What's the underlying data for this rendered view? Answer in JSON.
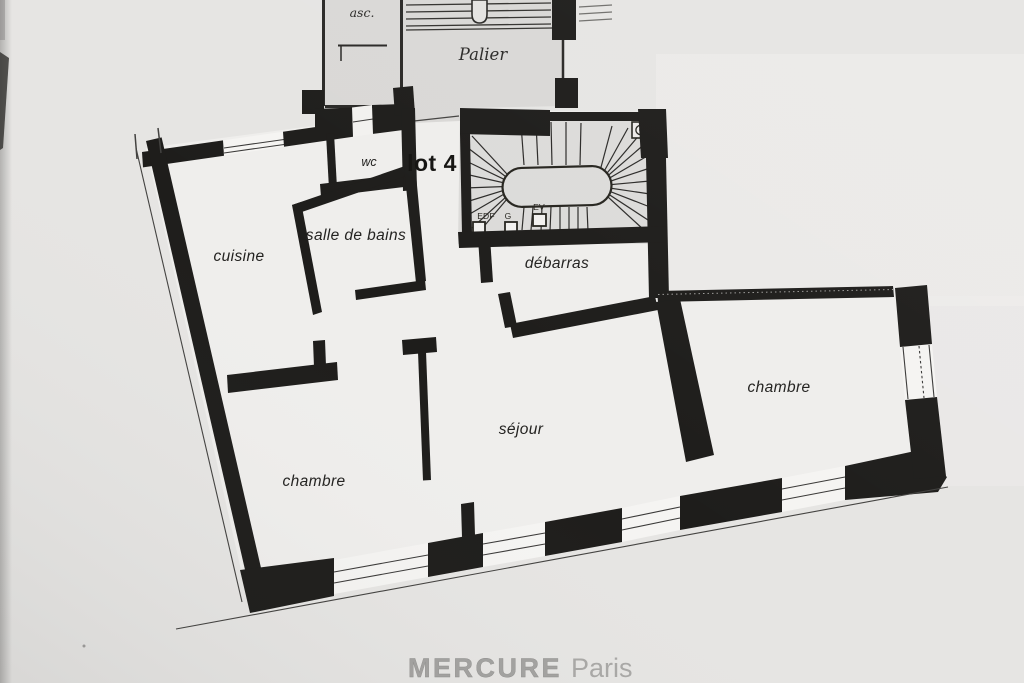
{
  "plan": {
    "unit_label": "lot 4",
    "common_areas": {
      "elevator": "asc.",
      "landing": "Palier"
    },
    "rooms": [
      {
        "id": "wc",
        "label": "wc"
      },
      {
        "id": "cuisine",
        "label": "cuisine"
      },
      {
        "id": "salle_de_bains",
        "label": "salle de bains"
      },
      {
        "id": "debarras",
        "label": "débarras"
      },
      {
        "id": "sejour",
        "label": "séjour"
      },
      {
        "id": "chambre_1",
        "label": "chambre"
      },
      {
        "id": "chambre_2",
        "label": "chambre"
      }
    ],
    "utility_closets": [
      {
        "label": "EDF"
      },
      {
        "label": "G"
      },
      {
        "label": "EV"
      }
    ],
    "watermark": {
      "brand": "MERCURE",
      "suffix": "Paris"
    },
    "colors": {
      "paper": "#e6e5e3",
      "ink": "#1e1d1b",
      "common_fill": "#d9d8d6",
      "room_fill": "#efeeec",
      "watermark": "#a5a4a2"
    }
  }
}
